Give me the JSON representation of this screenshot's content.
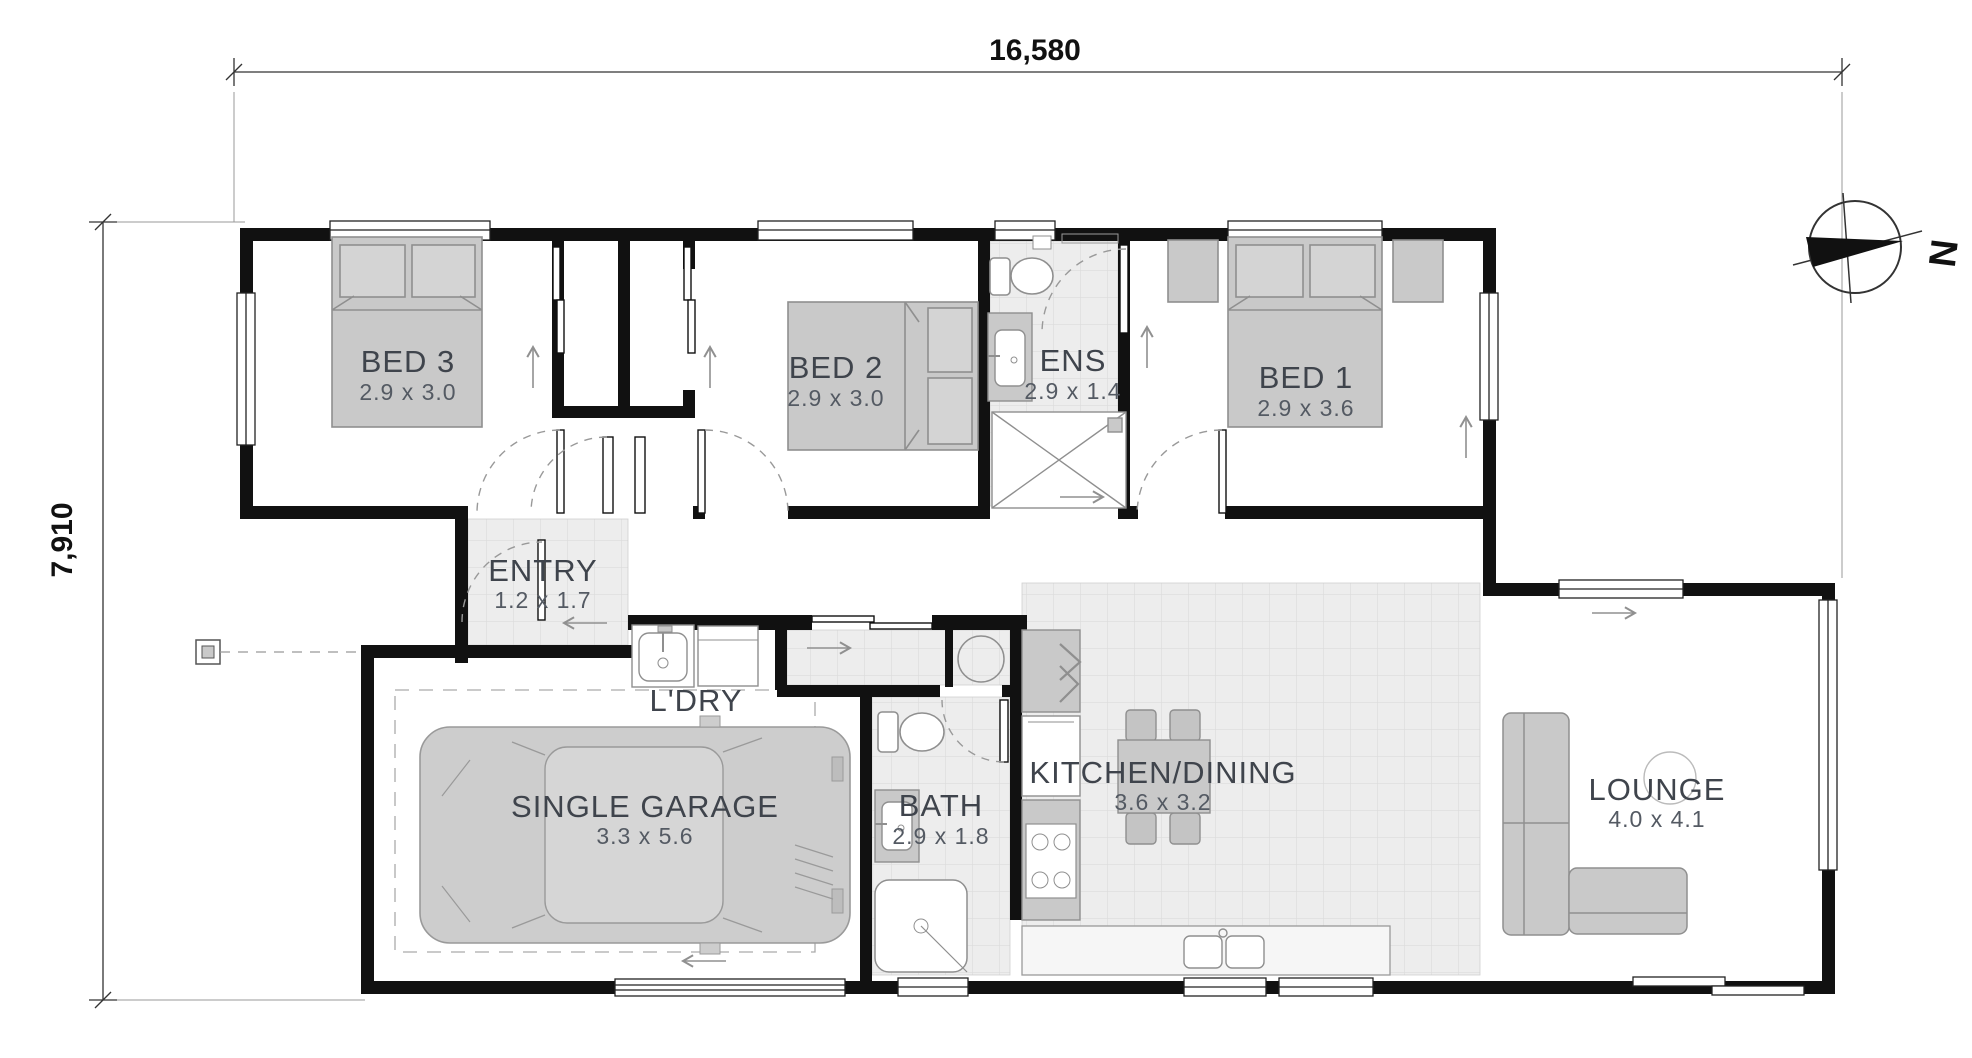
{
  "drawing": {
    "type": "floor-plan",
    "overall_width_label": "16,580",
    "overall_depth_label": "7,910",
    "compass_letter": "N"
  },
  "rooms": {
    "bed3": {
      "name": "BED 3",
      "dims": "2.9 x 3.0"
    },
    "bed2": {
      "name": "BED 2",
      "dims": "2.9 x 3.0"
    },
    "ens": {
      "name": "ENS",
      "dims": "2.9 x 1.4"
    },
    "bed1": {
      "name": "BED 1",
      "dims": "2.9 x 3.6"
    },
    "entry": {
      "name": "ENTRY",
      "dims": "1.2 x 1.7"
    },
    "ldry": {
      "name": "L'DRY",
      "dims": ""
    },
    "garage": {
      "name": "SINGLE GARAGE",
      "dims": "3.3 x 5.6"
    },
    "bath": {
      "name": "BATH",
      "dims": "2.9 x 1.8"
    },
    "kitchen": {
      "name": "KITCHEN/DINING",
      "dims": "3.6 x 3.2"
    },
    "lounge": {
      "name": "LOUNGE",
      "dims": "4.0 x 4.1"
    }
  },
  "colors": {
    "wall": "#111111",
    "fixture_fill": "#c9c9c9",
    "fixture_stroke": "#8f8f8f",
    "tile_fill": "#ededed",
    "tile_line": "#dcdcdc",
    "arrow": "#909090",
    "label": "#3f444c"
  }
}
